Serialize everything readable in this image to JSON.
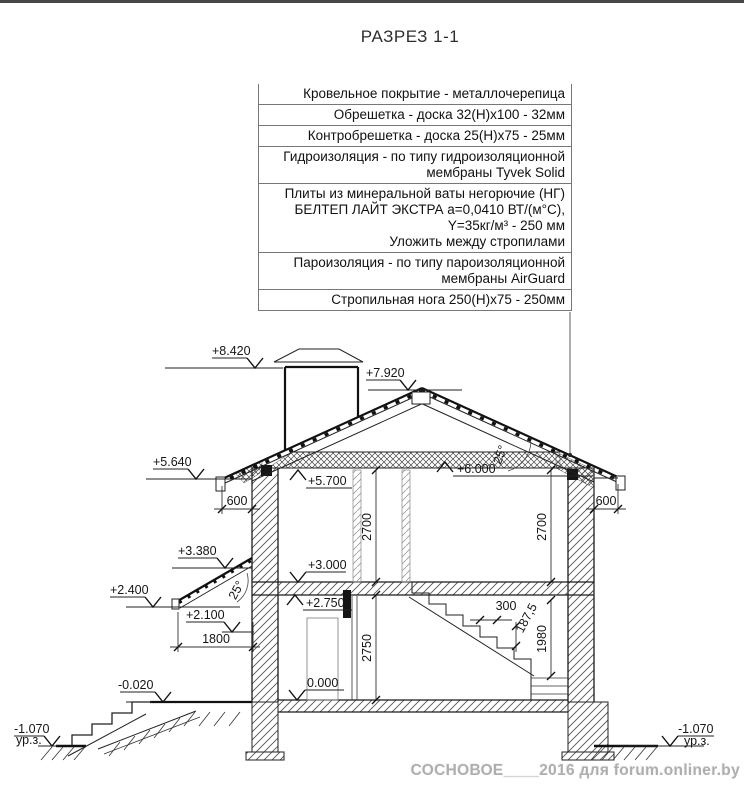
{
  "title": "РАЗРЕЗ 1-1",
  "legend": {
    "rows": [
      {
        "lines": [
          "Кровельное покрытие - металлочерепица"
        ]
      },
      {
        "lines": [
          "Обрешетка - доска 32(Н)х100 - 32мм"
        ]
      },
      {
        "lines": [
          "Контробрешетка - доска 25(Н)х75 - 25мм"
        ]
      },
      {
        "lines": [
          "Гидроизоляция -  по типу гидроизоляционной",
          "мембраны Tyvek Solid"
        ]
      },
      {
        "lines": [
          "Плиты из минеральной ваты негорючие (НГ)",
          "БЕЛТЕП  ЛАЙТ ЭКСТРА а=0,0410 ВТ/(м°С),",
          "Y=35кг/м³  - 250 мм",
          "Уложить между стропилами"
        ]
      },
      {
        "lines": [
          "Пароизоляция - по типу пароизоляционной",
          "мембраны AirGuard"
        ]
      },
      {
        "lines": [
          "Стропильная нога 250(Н)х75 - 250мм"
        ]
      }
    ]
  },
  "levels": {
    "top_chimney": "+8.420",
    "ridge": "+7.920",
    "eaves_left": "+5.640",
    "ceiling2": "+5.700",
    "attic_floor": "+6.000",
    "canopy_top": "+3.380",
    "canopy_low": "+2.400",
    "floor2": "+3.000",
    "ceiling1": "+2.750",
    "door_top": "+2.100",
    "porch": "-0.020",
    "floor1": "0.000",
    "ground_left": "-1.070",
    "ground_right": "-1.070"
  },
  "dims": {
    "eaves_left": "600",
    "eaves_right": "600",
    "room2_left": "2700",
    "room2_right": "2700",
    "room1": "2750",
    "porch_width": "1800",
    "tread": "300",
    "riser": "187,5",
    "stair_height": "1980"
  },
  "angles": {
    "roof": "25°",
    "canopy": "25°"
  },
  "labels": {
    "ground_level_left": "ур.з.",
    "ground_level_right": "ур.з."
  },
  "watermark": "СОСНОВОЕ____2016 для forum.onliner.by"
}
